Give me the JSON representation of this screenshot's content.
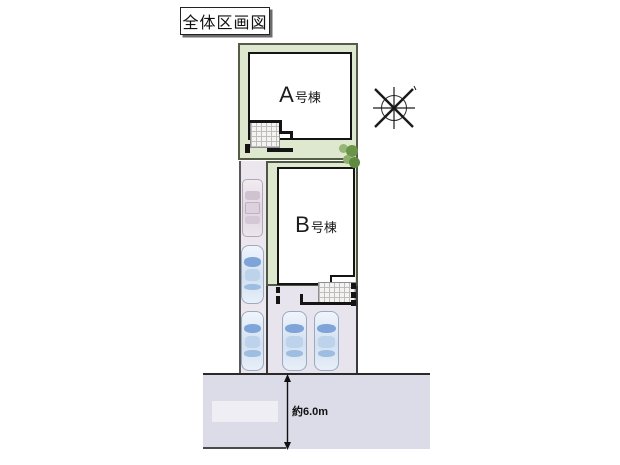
{
  "title": {
    "text": "全体区画図"
  },
  "lots": {
    "a": {
      "label": "A号棟",
      "letter": "A",
      "suffix": "号棟"
    },
    "b": {
      "label": "B号棟",
      "letter": "B",
      "suffix": "号棟"
    }
  },
  "road": {
    "width_label": "約6.0m"
  },
  "parking": {
    "car_count": 5,
    "blue_cars": 4,
    "pink_cars": 1
  },
  "icons": {
    "north": "north-compass-icon",
    "bush": "bush-icon",
    "car": "car-top-view-icon"
  },
  "colors": {
    "lot_green": "#dde8cf",
    "lot_border": "#4c5842",
    "parking_lavender": "#ece6ee",
    "road_gray": "#dcdce8",
    "building_fill": "#ffffff",
    "outline_black": "#141414",
    "car_blue": "#7fa5d8",
    "car_pink": "#e0d6e1",
    "bush_dark_green": "#5e8a42",
    "bush_light_green": "#8fae6e"
  }
}
